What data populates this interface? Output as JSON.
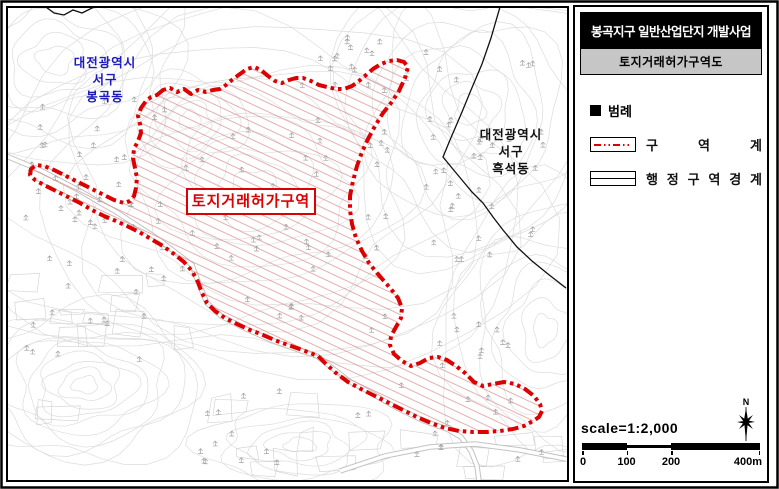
{
  "document": {
    "kind": "land-transaction-permission-zone-map"
  },
  "colors": {
    "zone_red": "#dd0000",
    "zone_hatch": "#d98c8c",
    "label_blue": "#1a1abe",
    "contour_gray": "#dcdcdc",
    "parcel_gray": "#cfcfcf",
    "road_gray": "#c2c2c2",
    "tree_gray": "#a3a3a3",
    "admin_black": "#111111",
    "title_bg": "#000000",
    "subtitle_bg": "#c6c6c6"
  },
  "panel": {
    "title": "봉곡지구 일반산업단지 개발사업",
    "subtitle": "토지거래허가구역도",
    "legend": {
      "header": "범례",
      "items": [
        {
          "label": "구역계",
          "line_style": "red-dash-dot"
        },
        {
          "label": "행정구역경계",
          "line_style": "black-solid"
        }
      ]
    },
    "scale": {
      "text": "scale=1:2,000",
      "tick_labels": [
        "0",
        "100",
        "200",
        "400m"
      ]
    },
    "compass_label": "N"
  },
  "map": {
    "regions": [
      {
        "lines": [
          "대전광역시",
          "서구",
          "봉곡동"
        ],
        "color_name": "blue"
      },
      {
        "lines": [
          "대전광역시",
          "서구",
          "흑석동"
        ],
        "color_name": "black"
      }
    ],
    "zone_label": "토지거래허가구역"
  }
}
